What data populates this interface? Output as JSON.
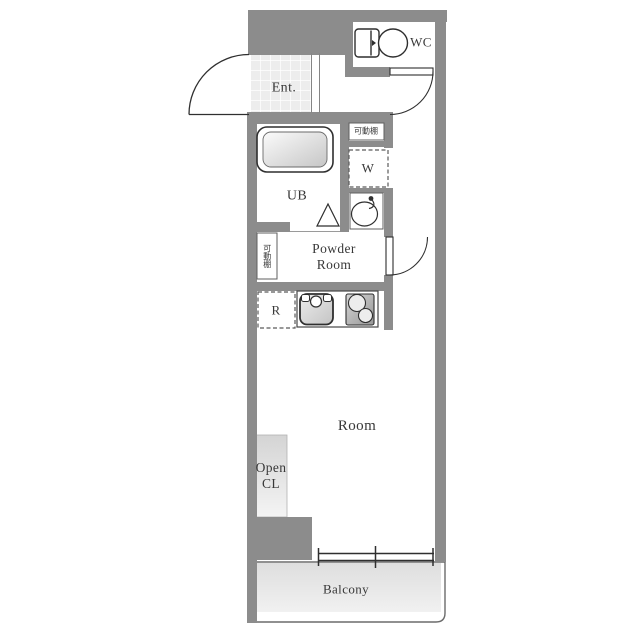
{
  "labels": {
    "wc": "WC",
    "entrance": "Ent.",
    "unit_bath": "UB",
    "washer": "W",
    "shelf_top": "可動棚",
    "shelf_side": "可動棚",
    "powder_line1": "Powder",
    "powder_line2": "Room",
    "refrigerator": "R",
    "room": "Room",
    "open_cl_line1": "Open",
    "open_cl_line2": "CL",
    "balcony": "Balcony"
  },
  "colors": {
    "wall": "#8c8c8c",
    "tile_floor": "#ededed",
    "balcony_floor": "#e4e4e4",
    "closet_fill": "#dcdcdc",
    "text": "#383838",
    "fixture_line": "#2f2f2f"
  }
}
